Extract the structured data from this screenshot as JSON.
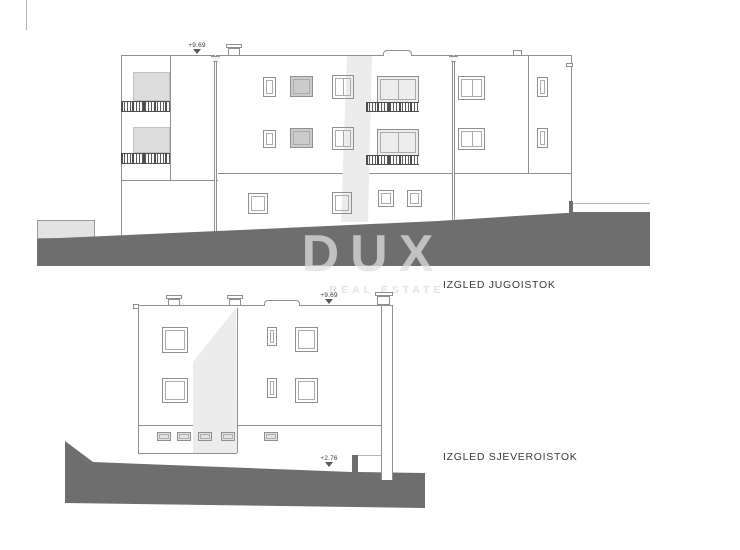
{
  "drawing": {
    "type": "architectural-elevations",
    "watermark": {
      "text": "DUX",
      "subtext": "REAL ESTATE"
    },
    "colors": {
      "terrain": "#6e6e6e",
      "outline": "#8f8f8f",
      "balcony_panel": "#dcdcdc",
      "shading": "#ececec",
      "label_text": "#3a3a3a"
    },
    "elevations": [
      {
        "label": "IZGLED JUGOISTOK",
        "levels": {
          "roof": "+9.69"
        }
      },
      {
        "label": "IZGLED SJEVEROISTOK",
        "levels": {
          "roof": "+9.69",
          "terrace": "+2.76"
        }
      }
    ]
  }
}
